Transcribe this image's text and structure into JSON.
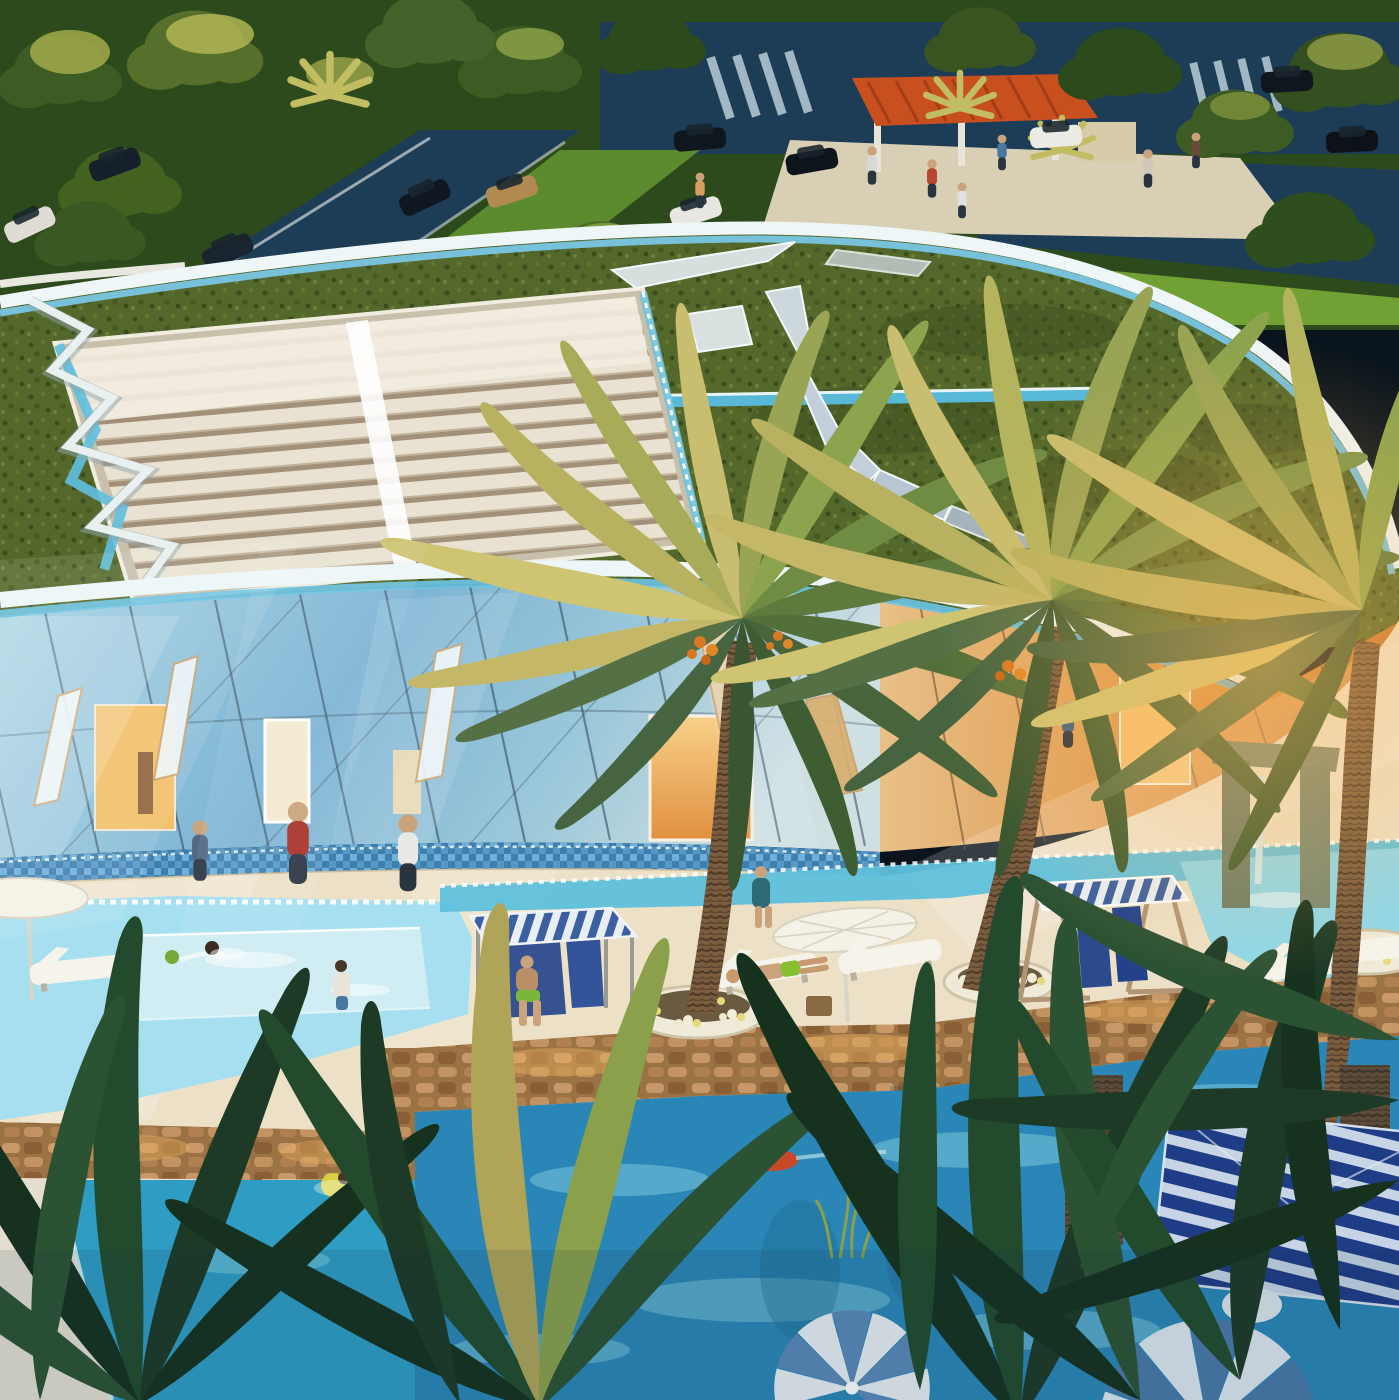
{
  "scene": {
    "title": "aerial-rendering-resort-clubhouse-lagoon-pools",
    "setting": "sunset aerial rendering of a curved glass clubhouse with a landscaped green roof, date palms and lagoon pools",
    "elements": [
      "tree-lined parking road with cars",
      "orange slatted pergola on plaza",
      "curved green living roof",
      "white louvered skylight vault",
      "zigzag white roof path",
      "angular skylight slits in roof lawn",
      "curved blue glass facade with diagonal mullions",
      "warm lit doorways",
      "mosaic waterline band",
      "cream pool deck",
      "blue striped cabana",
      "canopy swing seat",
      "white sun loungers",
      "white market umbrellas",
      "flower planters at palm bases",
      "stone walls bridges and piers",
      "stone waterfall portal",
      "lagoon pools with swimmers",
      "navy striped pavilion roof",
      "radial striped parasols",
      "foreground palm fronds"
    ],
    "people_visible": 24,
    "cars_visible": 11
  },
  "palette": {
    "foliage_dark": "#2c4a1c",
    "foliage_mid": "#3d5c24",
    "foliage_lit": "#aab04e",
    "lawn": "#5c8a2e",
    "lawn_bright": "#71a034",
    "road": "#1d3c55",
    "plaza": "#d9cfb4",
    "pergola": "#c8501e",
    "rim_white": "#eef6f8",
    "rim_cyan": "#79c6e4",
    "skylight_slat": "#e9e2d2",
    "glass_cool": "#7db4d4",
    "glass_warm": "#dc9448",
    "mullion": "#24384a",
    "door_glow": "#f2c068",
    "mosaic": "#4a88b8",
    "deck": "#ece0c6",
    "pool_shallow": "#a6dff0",
    "pool_mid": "#5fc0dc",
    "pool_deep": "#2a86b6",
    "pool_left_lower": "#2f9cc4",
    "stone": "#b08050",
    "stone_dark": "#7a5632",
    "cabana_blue": "#3b5fa0",
    "canvas_white": "#e9eef5",
    "seat_navy": "#2c4a8e",
    "wood": "#b29574",
    "trunk": "#7a5c3e",
    "palm_sun": "#c9bd6f",
    "palm_shadow": "#3f5d33",
    "frond_dark": "#1d3a27",
    "umbrella_white": "#f4f1e6",
    "parasol_blue": "#5a88b8",
    "flower_purple": "#9a6aa8",
    "skin": "#caa27c"
  }
}
